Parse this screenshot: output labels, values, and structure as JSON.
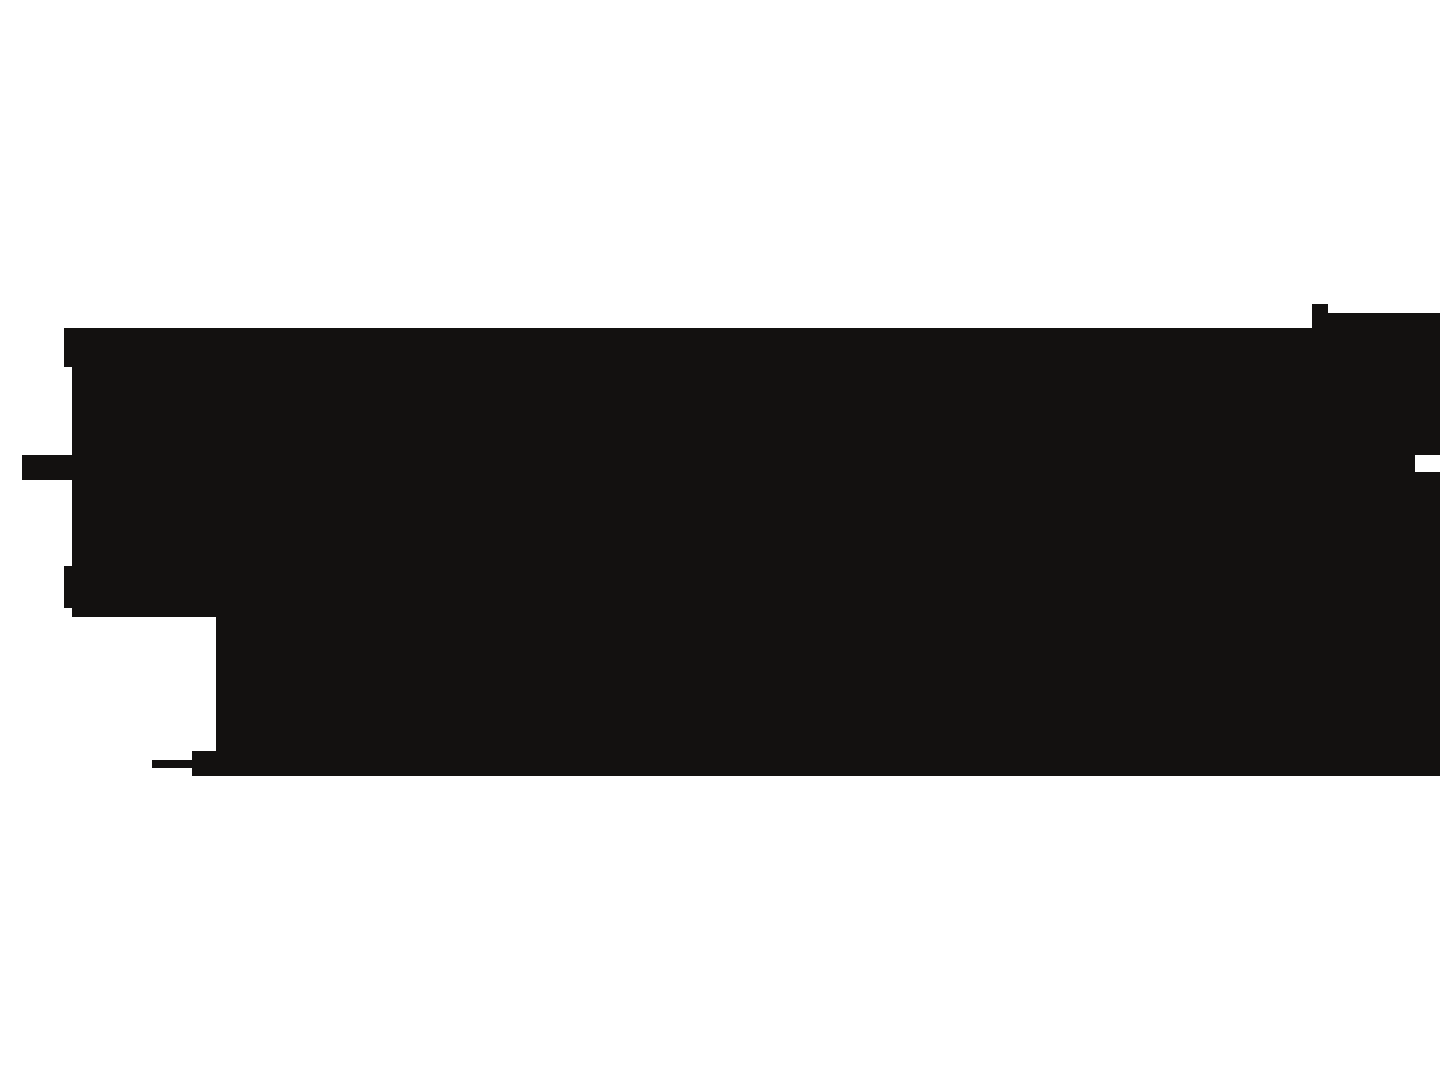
{
  "canvas": {
    "width": 1440,
    "height": 1080
  },
  "colors": {
    "background": "#ffffff",
    "shape_fill": "#131110"
  },
  "shape": {
    "name": "black-silhouette-blob",
    "description": "large solid irregular rectangular silhouette with stepped edges",
    "points": [
      [
        64,
        328
      ],
      [
        1312,
        328
      ],
      [
        1312,
        304
      ],
      [
        1328,
        304
      ],
      [
        1328,
        313
      ],
      [
        1440,
        313
      ],
      [
        1440,
        455
      ],
      [
        1415,
        455
      ],
      [
        1415,
        472
      ],
      [
        1440,
        472
      ],
      [
        1440,
        776
      ],
      [
        192,
        776
      ],
      [
        192,
        768
      ],
      [
        152,
        768
      ],
      [
        152,
        760
      ],
      [
        192,
        760
      ],
      [
        192,
        751
      ],
      [
        216,
        751
      ],
      [
        216,
        617
      ],
      [
        72,
        617
      ],
      [
        72,
        608
      ],
      [
        64,
        608
      ],
      [
        64,
        566
      ],
      [
        72,
        566
      ],
      [
        72,
        480
      ],
      [
        22,
        480
      ],
      [
        22,
        455
      ],
      [
        72,
        455
      ],
      [
        72,
        367
      ],
      [
        64,
        367
      ]
    ]
  }
}
